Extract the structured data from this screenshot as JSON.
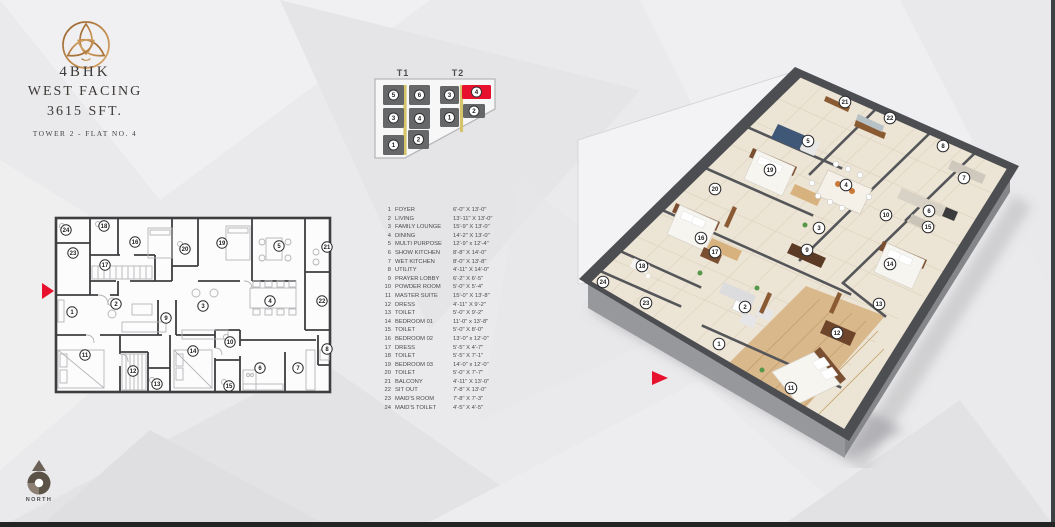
{
  "header": {
    "title_line1": "4BHK",
    "title_line2": "WEST FACING",
    "title_line3": "3615 SFT.",
    "subtitle": "TOWER 2 - FLAT NO. 4"
  },
  "icons": {
    "logo": "trefoil-knot-logo-icon",
    "compass": "north-compass-icon",
    "entry_marker": "red-entry-arrow-icon"
  },
  "compass": {
    "label": "NORTH"
  },
  "key_plan": {
    "towers": [
      {
        "label": "T1",
        "label_x": 403,
        "label_y": 76,
        "core": {
          "x": 405,
          "y1": 85,
          "y2": 155
        },
        "units": [
          {
            "n": "5",
            "x": 383,
            "y": 85,
            "w": 21,
            "h": 20
          },
          {
            "n": "6",
            "x": 409,
            "y": 85,
            "w": 21,
            "h": 20
          },
          {
            "n": "3",
            "x": 383,
            "y": 108,
            "w": 21,
            "h": 20
          },
          {
            "n": "4",
            "x": 409,
            "y": 108,
            "w": 21,
            "h": 21
          },
          {
            "n": "1",
            "x": 383,
            "y": 135,
            "w": 21,
            "h": 20
          },
          {
            "n": "2",
            "x": 408,
            "y": 130,
            "w": 21,
            "h": 19
          }
        ]
      },
      {
        "label": "T2",
        "label_x": 458,
        "label_y": 76,
        "core": {
          "x": 461.5,
          "y1": 85,
          "y2": 132
        },
        "units": [
          {
            "n": "3",
            "x": 440,
            "y": 86,
            "w": 19,
            "h": 18
          },
          {
            "n": "4",
            "x": 462,
            "y": 85,
            "w": 29,
            "h": 14,
            "highlight": true
          },
          {
            "n": "1",
            "x": 440,
            "y": 108,
            "w": 19,
            "h": 19
          },
          {
            "n": "2",
            "x": 463,
            "y": 104,
            "w": 22,
            "h": 14
          }
        ]
      }
    ]
  },
  "legend": {
    "rooms": [
      {
        "no": "1",
        "name": "FOYER",
        "size": "6'-0\" X 13'-0\""
      },
      {
        "no": "2",
        "name": "LIVING",
        "size": "13'-11\" X 13'-0\""
      },
      {
        "no": "3",
        "name": "FAMILY LOUNGE",
        "size": "15'-9\" X 13'-0\""
      },
      {
        "no": "4",
        "name": "DINING",
        "size": "14'-2\" X 13'-0\""
      },
      {
        "no": "5",
        "name": "MULTI PURPOSE",
        "size": "12'-9\" x 12'-4\""
      },
      {
        "no": "6",
        "name": "SHOW KITCHEN",
        "size": "8'-8\" X 14'-0\""
      },
      {
        "no": "7",
        "name": "WET KITCHEN",
        "size": "8'-0\" X 13'-8\""
      },
      {
        "no": "8",
        "name": "UTILITY",
        "size": "4'-11\" X 14'-0\""
      },
      {
        "no": "9",
        "name": "PRAYER LOBBY",
        "size": "6'-2\" X 6'-5\""
      },
      {
        "no": "10",
        "name": "POWDER ROOM",
        "size": "5'-0\" X 5'-4\""
      },
      {
        "no": "11",
        "name": "MASTER SUITE",
        "size": "15'-0\" X 13'-8\""
      },
      {
        "no": "12",
        "name": "DRESS",
        "size": "4'-11\" X 9'-2\""
      },
      {
        "no": "13",
        "name": "TOILET",
        "size": "5'-0\" X 9'-2\""
      },
      {
        "no": "14",
        "name": "BEDROOM 01",
        "size": "11'-0\" x 13'-8\""
      },
      {
        "no": "15",
        "name": "TOILET",
        "size": "5'-0\" X 8'-0\""
      },
      {
        "no": "16",
        "name": "BEDROOM 02",
        "size": "13'-0\" x 12'-0\""
      },
      {
        "no": "17",
        "name": "DRESS",
        "size": "5'-5\" X 4'-7\""
      },
      {
        "no": "18",
        "name": "TOILET",
        "size": "5'-5\" X 7'-1\""
      },
      {
        "no": "19",
        "name": "BEDROOM 03",
        "size": "14'-0\" x 12'-0\""
      },
      {
        "no": "20",
        "name": "TOILET",
        "size": "5'-0\" X 7'-7\""
      },
      {
        "no": "21",
        "name": "BALCONY",
        "size": "4'-11\" X 13'-0\""
      },
      {
        "no": "22",
        "name": "SIT OUT",
        "size": "7'-8\" X 13'-0\""
      },
      {
        "no": "23",
        "name": "MAID'S ROOM",
        "size": "7'-8\" X 7'-3\""
      },
      {
        "no": "24",
        "name": "MAID'S TOILET",
        "size": "4'-5\" X 4'-5\""
      }
    ]
  },
  "plan2d": {
    "markers": [
      {
        "n": "1",
        "x": 72,
        "y": 312
      },
      {
        "n": "2",
        "x": 116,
        "y": 304
      },
      {
        "n": "3",
        "x": 203,
        "y": 306
      },
      {
        "n": "4",
        "x": 270,
        "y": 301
      },
      {
        "n": "5",
        "x": 279,
        "y": 246
      },
      {
        "n": "6",
        "x": 260,
        "y": 368
      },
      {
        "n": "7",
        "x": 298,
        "y": 368
      },
      {
        "n": "8",
        "x": 327,
        "y": 349
      },
      {
        "n": "9",
        "x": 166,
        "y": 318
      },
      {
        "n": "10",
        "x": 230,
        "y": 342
      },
      {
        "n": "11",
        "x": 85,
        "y": 355
      },
      {
        "n": "12",
        "x": 133,
        "y": 371
      },
      {
        "n": "13",
        "x": 157,
        "y": 384
      },
      {
        "n": "14",
        "x": 193,
        "y": 351
      },
      {
        "n": "15",
        "x": 229,
        "y": 386
      },
      {
        "n": "16",
        "x": 135,
        "y": 242
      },
      {
        "n": "17",
        "x": 105,
        "y": 265
      },
      {
        "n": "18",
        "x": 104,
        "y": 226
      },
      {
        "n": "19",
        "x": 222,
        "y": 243
      },
      {
        "n": "20",
        "x": 185,
        "y": 249
      },
      {
        "n": "21",
        "x": 327,
        "y": 247
      },
      {
        "n": "22",
        "x": 322,
        "y": 301
      },
      {
        "n": "23",
        "x": 73,
        "y": 253
      },
      {
        "n": "24",
        "x": 66,
        "y": 230
      }
    ]
  },
  "plan3d": {
    "markers": [
      {
        "n": "1",
        "x": 719,
        "y": 344
      },
      {
        "n": "2",
        "x": 745,
        "y": 307
      },
      {
        "n": "3",
        "x": 819,
        "y": 228
      },
      {
        "n": "4",
        "x": 846,
        "y": 185
      },
      {
        "n": "5",
        "x": 808,
        "y": 141
      },
      {
        "n": "6",
        "x": 929,
        "y": 211
      },
      {
        "n": "7",
        "x": 964,
        "y": 178
      },
      {
        "n": "8",
        "x": 943,
        "y": 146
      },
      {
        "n": "9",
        "x": 807,
        "y": 250
      },
      {
        "n": "10",
        "x": 886,
        "y": 215
      },
      {
        "n": "11",
        "x": 791,
        "y": 388
      },
      {
        "n": "12",
        "x": 837,
        "y": 333
      },
      {
        "n": "13",
        "x": 879,
        "y": 304
      },
      {
        "n": "14",
        "x": 890,
        "y": 264
      },
      {
        "n": "15",
        "x": 928,
        "y": 227
      },
      {
        "n": "16",
        "x": 701,
        "y": 238
      },
      {
        "n": "17",
        "x": 715,
        "y": 252
      },
      {
        "n": "18",
        "x": 642,
        "y": 266
      },
      {
        "n": "19",
        "x": 770,
        "y": 170
      },
      {
        "n": "20",
        "x": 715,
        "y": 189
      },
      {
        "n": "21",
        "x": 845,
        "y": 102
      },
      {
        "n": "22",
        "x": 890,
        "y": 118
      },
      {
        "n": "23",
        "x": 646,
        "y": 303
      },
      {
        "n": "24",
        "x": 603,
        "y": 282
      }
    ]
  },
  "colors": {
    "accent_red": "#E8112D",
    "logo_gold_dark": "#96642E",
    "logo_gold_light": "#D9A867",
    "unit_gray": "#666769",
    "core_gold": "#D6C46A",
    "wall_dark": "#4D4E52",
    "floor_beige": "#ECE4D4",
    "wood_floor": "#D9B88C",
    "compass_brown": "#5C5348"
  }
}
